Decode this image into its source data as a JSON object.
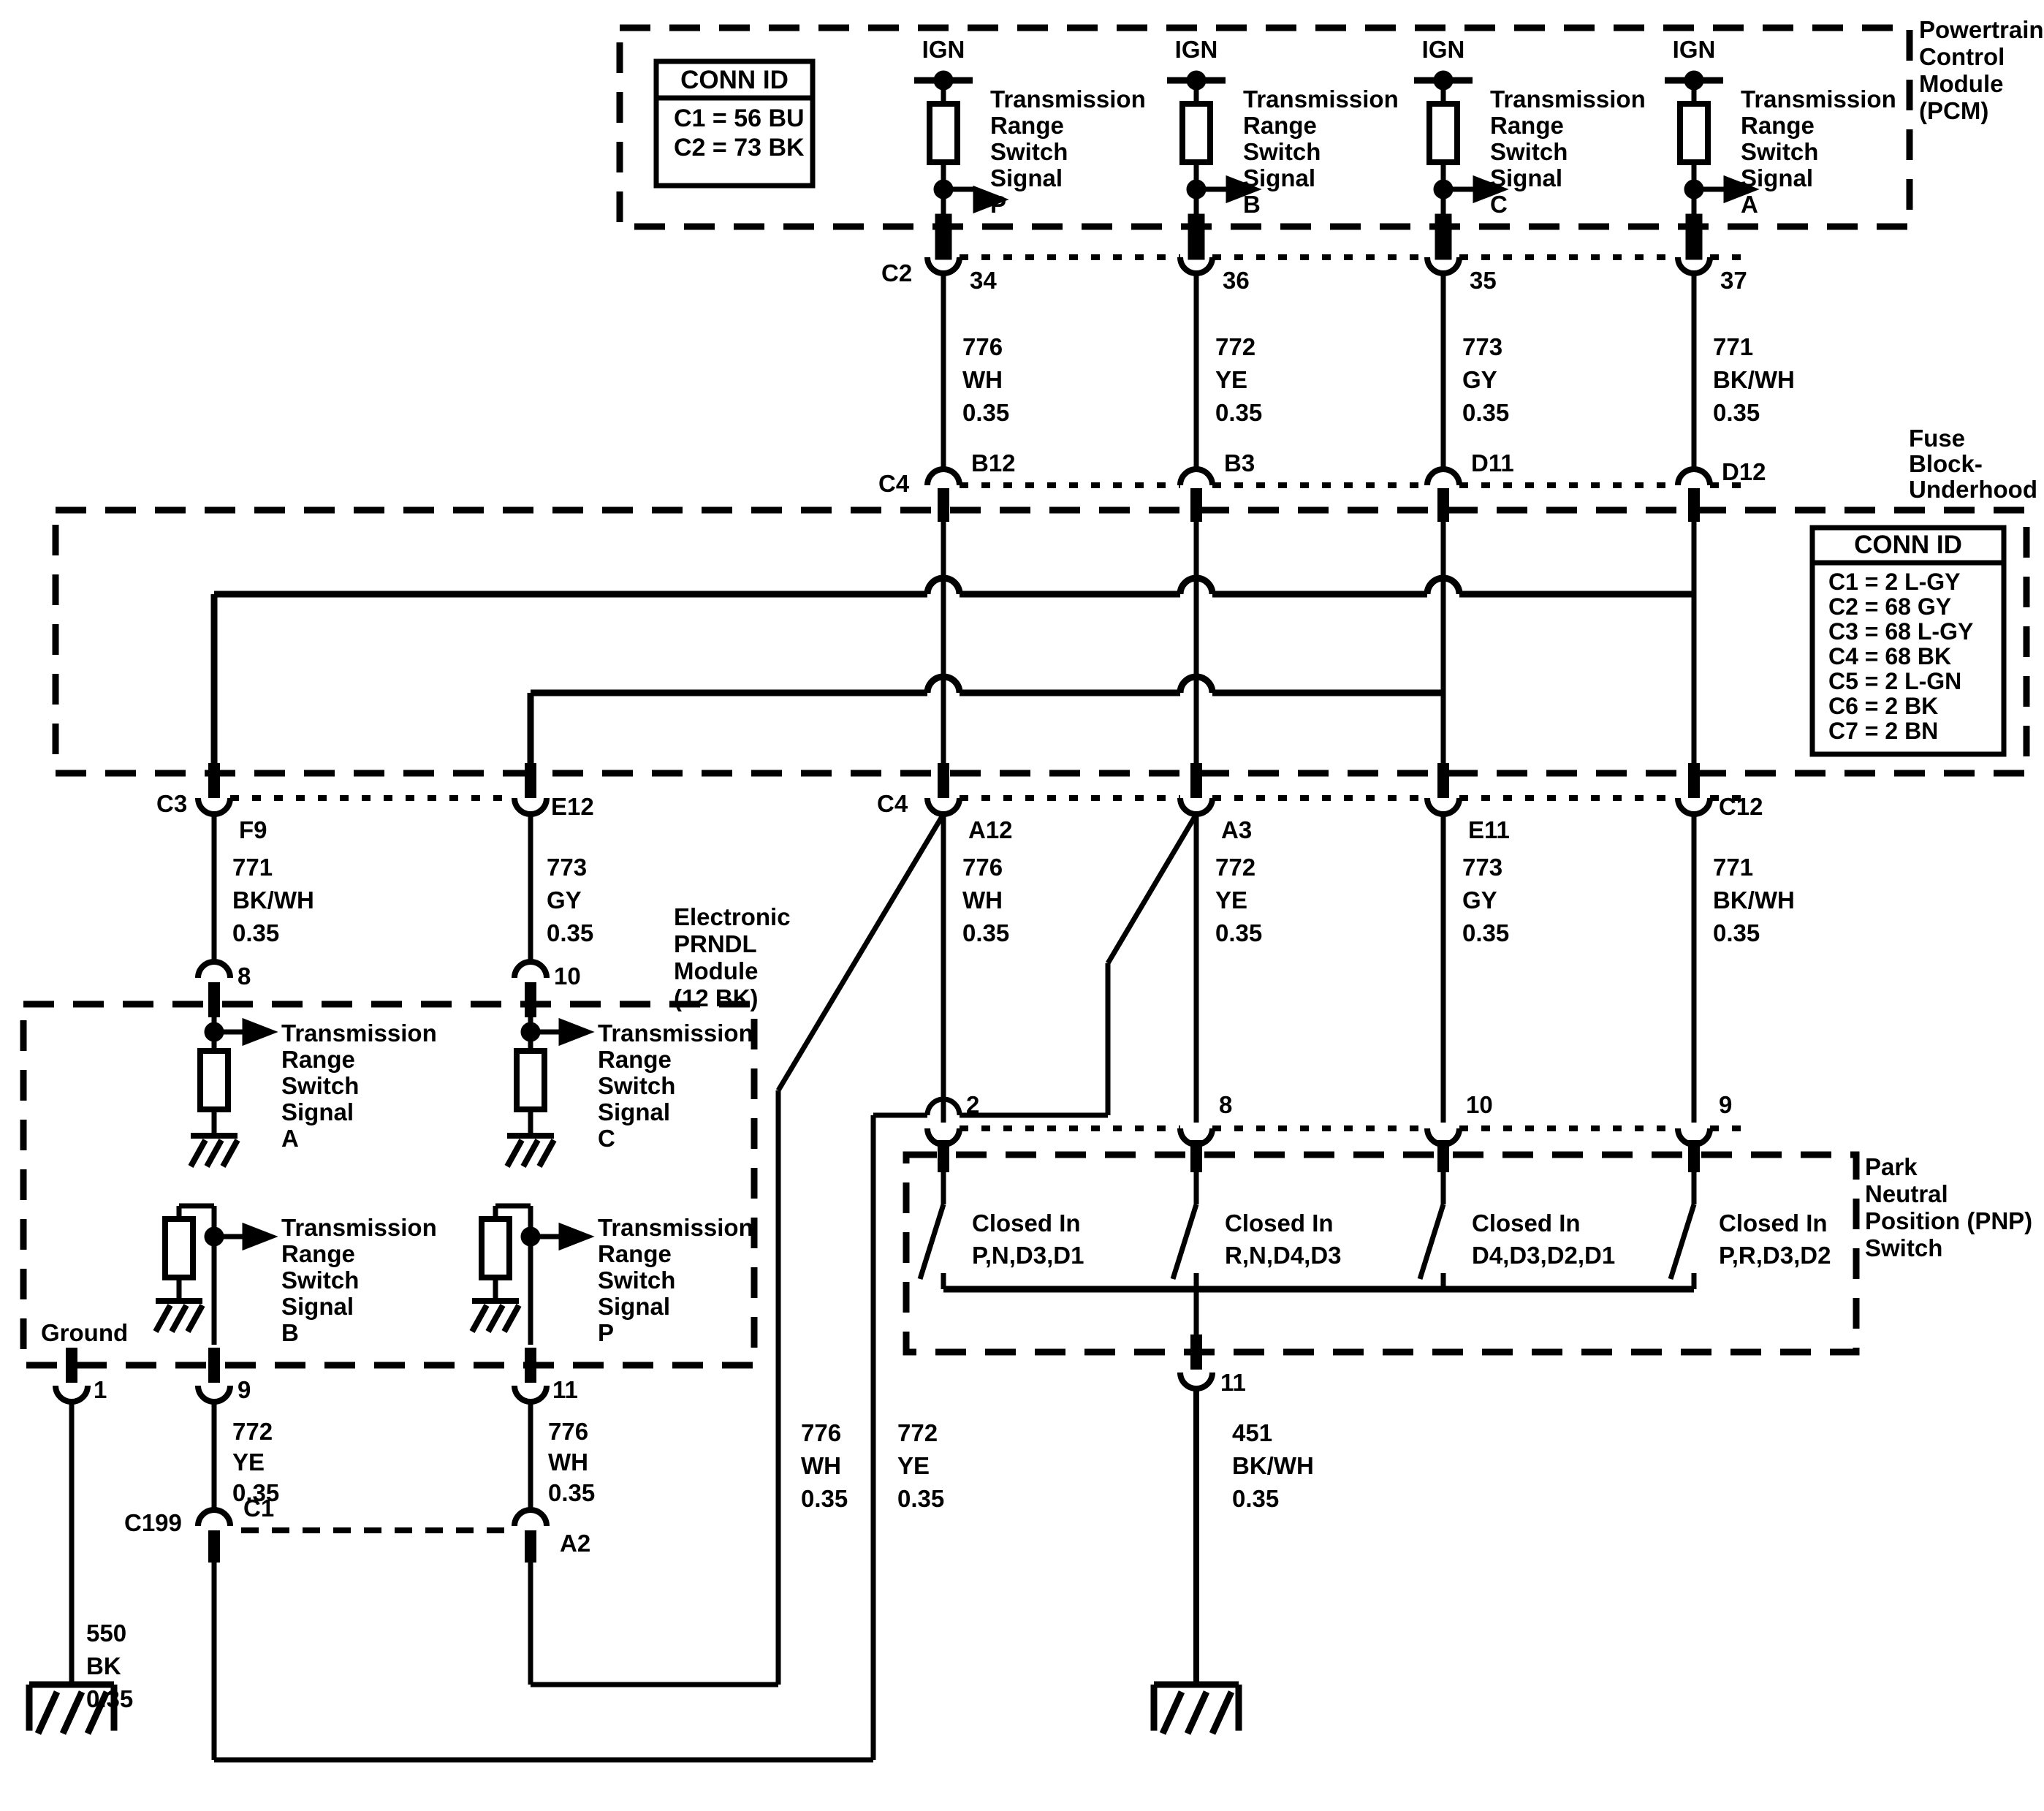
{
  "pcm": {
    "module_label": "Powertrain\nControl\nModule\n(PCM)",
    "conn_id": {
      "title": "CONN ID",
      "row1": "C1 = 56 BU",
      "row2": "C2 = 73 BK"
    },
    "ign": "IGN",
    "signal_p": "Transmission\nRange\nSwitch\nSignal\nP",
    "signal_b": "Transmission\nRange\nSwitch\nSignal\nB",
    "signal_c": "Transmission\nRange\nSwitch\nSignal\nC",
    "signal_a": "Transmission\nRange\nSwitch\nSignal\nA",
    "connector_label": "C2",
    "pin_col1": "34",
    "pin_col2": "36",
    "pin_col3": "35",
    "pin_col4": "37"
  },
  "wires_top": {
    "col1": "776\nWH\n0.35",
    "col2": "772\nYE\n0.35",
    "col3": "773\nGY\n0.35",
    "col4": "771\nBK/WH\n0.35"
  },
  "fuse": {
    "block_label": "Fuse\nBlock-\nUnderhood",
    "connector_top_label": "C4",
    "pin_b12": "B12",
    "pin_b3": "B3",
    "pin_d11": "D11",
    "pin_d12": "D12",
    "conn_id": {
      "title": "CONN ID",
      "row1": "C1 = 2 L-GY",
      "row2": "C2 = 68 GY",
      "row3": "C3 = 68 L-GY",
      "row4": "C4 = 68 BK",
      "row5": "C5 = 2 L-GN",
      "row6": "C6 = 2 BK",
      "row7": "C7 = 2 BN"
    },
    "connector_bottom_left_label": "C3",
    "connector_bottom_mid_label": "C4",
    "pin_f9": "F9",
    "pin_e12": "E12",
    "pin_a12": "A12",
    "pin_a3": "A3",
    "pin_e11": "E11",
    "pin_c12": "C12"
  },
  "wires_mid": {
    "f9": "771\nBK/WH\n0.35",
    "e12": "773\nGY\n0.35",
    "a12": "776\nWH\n0.35",
    "a3": "772\nYE\n0.35",
    "e11": "773\nGY\n0.35",
    "c12": "771\nBK/WH\n0.35"
  },
  "prndl": {
    "module_label": "Electronic\nPRNDL\nModule\n(12 BK)",
    "pin8": "8",
    "pin10": "10",
    "signal_a": "Transmission\nRange\nSwitch\nSignal\nA",
    "signal_c": "Transmission\nRange\nSwitch\nSignal\nC",
    "signal_b": "Transmission\nRange\nSwitch\nSignal\nB",
    "signal_p": "Transmission\nRange\nSwitch\nSignal\nP",
    "ground_label": "Ground",
    "pin1": "1",
    "pin9": "9",
    "pin11": "11"
  },
  "wires_bottom": {
    "pin9": "772\nYE\n0.35",
    "pin11": "776\nWH\n0.35",
    "mid_776": "776\nWH\n0.35",
    "mid_772": "772\nYE\n0.35",
    "w451": "451\nBK/WH\n0.35",
    "w550": "550\nBK\n0.35"
  },
  "c199": {
    "label": "C199",
    "pin_c1": "C1",
    "pin_a2": "A2"
  },
  "pnp": {
    "switch_label": "Park\nNeutral\nPosition (PNP)\nSwitch",
    "pin2": "2",
    "pin8": "8",
    "pin10": "10",
    "pin9": "9",
    "sw1": "Closed In\nP,N,D3,D1",
    "sw2": "Closed In\nR,N,D4,D3",
    "sw3": "Closed In\nD4,D3,D2,D1",
    "sw4": "Closed In\nP,R,D3,D2",
    "pin11": "11"
  },
  "colors": {
    "ink": "#000000",
    "paper": "#ffffff"
  }
}
